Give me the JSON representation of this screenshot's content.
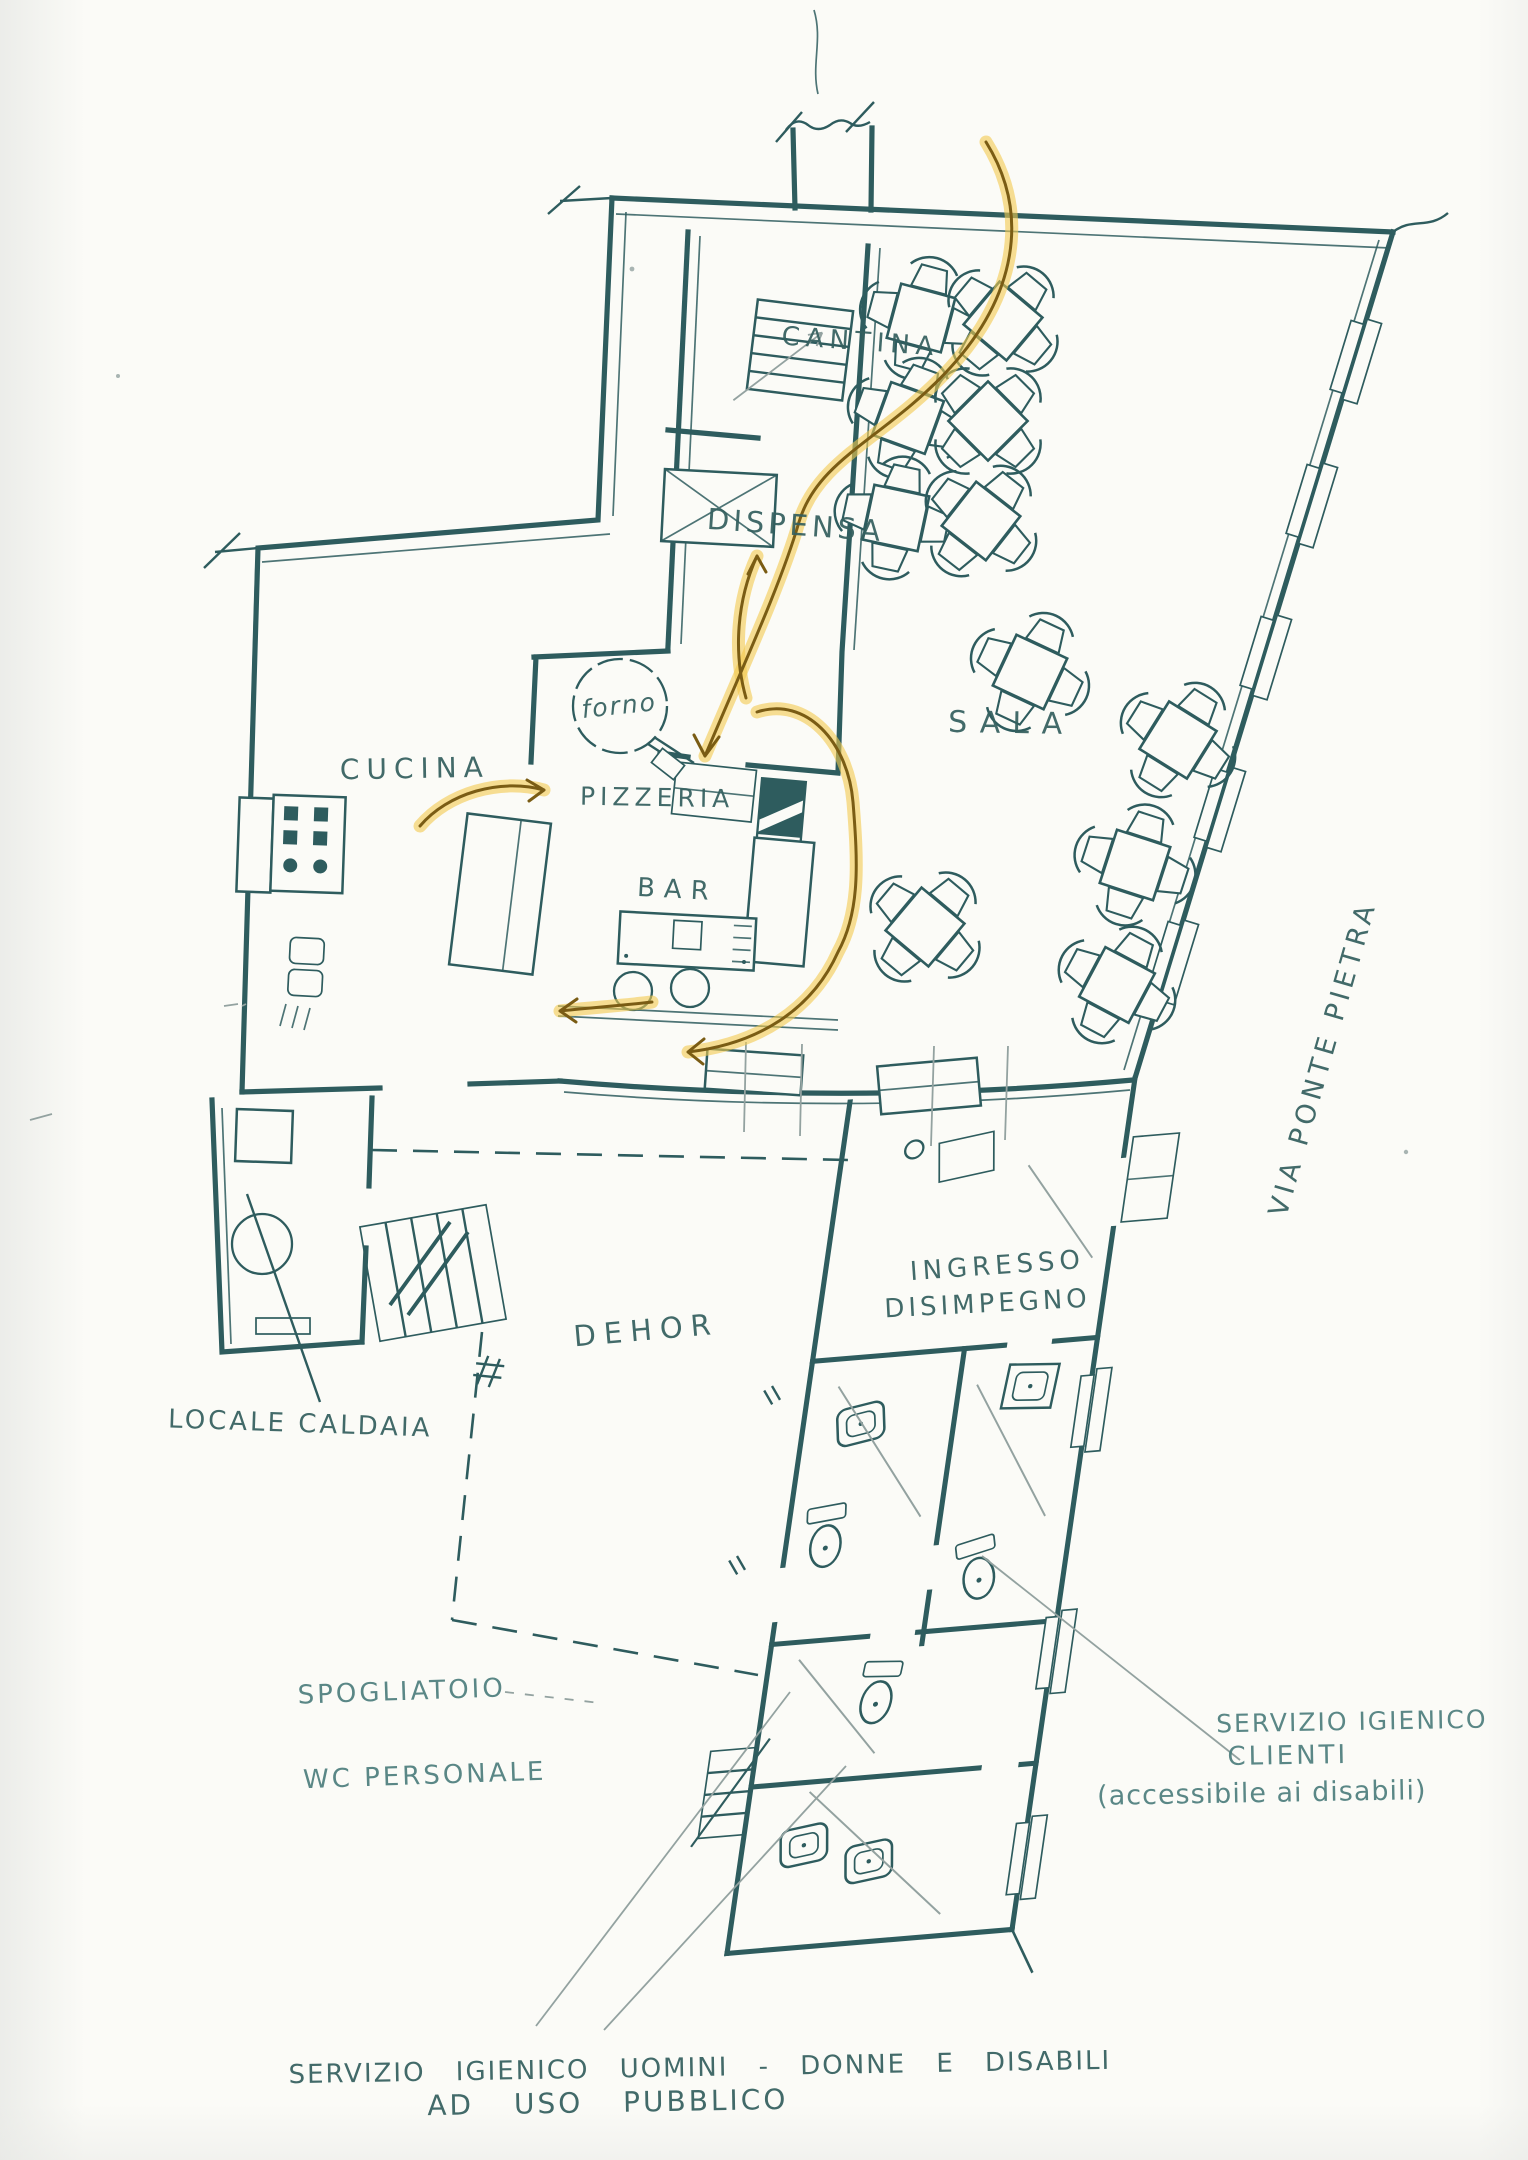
{
  "drawing_type": "hand-drawn restaurant floor plan (scanned sketch)",
  "labels": {
    "cantina": "CANTINA",
    "dispensa": "DISPENSA",
    "sala": "SALA",
    "cucina": "CUCINA",
    "forno": "forno",
    "pizzeria": "PIZZERIA",
    "bar": "BAR",
    "ingresso": "INGRESSO",
    "disimpegno": "DISIMPEGNO",
    "dehor": "DEHOR",
    "locale_caldaia": "LOCALE CALDAIA",
    "spogliatoio": "SPOGLIATOIO",
    "wc_personale": "WC PERSONALE",
    "via_ponte_pietra": "VIA PONTE PIETRA"
  },
  "annotations": {
    "servizio_clienti": [
      "SERVIZIO IGIENICO",
      "CLIENTI",
      "(accessibile ai disabili)"
    ],
    "servizio_pubblico": [
      "SERVIZIO IGIENICO  UOMINI - DONNE  E  DISABILI",
      "AD  USO  PUBBLICO"
    ]
  },
  "colors": {
    "ink": "#2e5c5e",
    "ink-text": "#35605f",
    "teal": "#4e7f7e",
    "pencil": "#93a2a0",
    "highlight": "#f4c94f",
    "arrow": "#7a5c14",
    "paper": "#fbfbf7"
  },
  "furniture": {
    "sala_tables": [
      {
        "x": 921,
        "y": 318,
        "r": 15
      },
      {
        "x": 1003,
        "y": 321,
        "r": 40
      },
      {
        "x": 908,
        "y": 418,
        "r": 20
      },
      {
        "x": 988,
        "y": 421,
        "r": 45
      },
      {
        "x": 896,
        "y": 518,
        "r": 12
      },
      {
        "x": 981,
        "y": 521,
        "r": 38
      },
      {
        "x": 1030,
        "y": 672,
        "r": 25
      },
      {
        "x": 1178,
        "y": 740,
        "r": 32
      },
      {
        "x": 1135,
        "y": 865,
        "r": 18
      },
      {
        "x": 925,
        "y": 927,
        "r": 40
      },
      {
        "x": 1117,
        "y": 985,
        "r": 28
      }
    ],
    "bar_stools": 2
  },
  "flow_arrows": [
    "delivery-route-cantina-to-pizzeria",
    "pizzeria-to-dispensa",
    "cucina-to-pizzeria",
    "bar-to-dehor",
    "bar-to-cucina"
  ]
}
